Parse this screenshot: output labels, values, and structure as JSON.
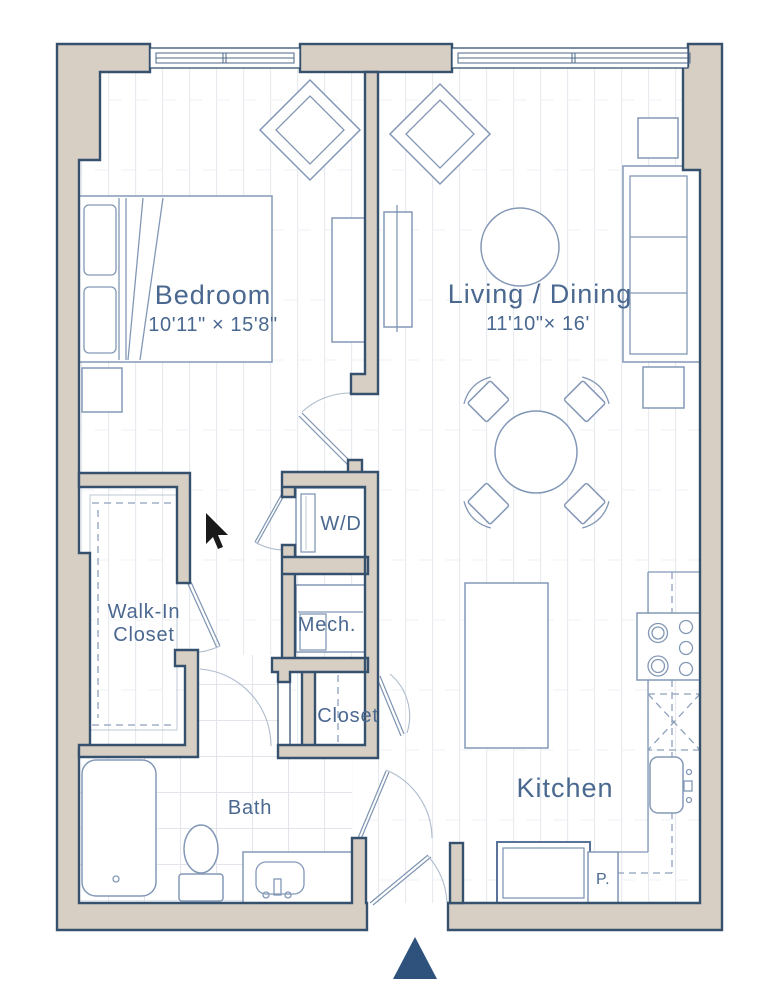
{
  "plan": {
    "colors": {
      "wall_fill": "#d7cfc3",
      "wall_outline": "#35516e",
      "furniture_line": "#8398b6",
      "label_text": "#4a6890",
      "floor_line": "#e7eaee",
      "tile_line": "#e2e6ec",
      "entry_marker": "#2e527c"
    },
    "rooms": {
      "bedroom": {
        "label": "Bedroom",
        "dims": "10'11\" × 15'8\""
      },
      "living_dining": {
        "label": "Living / Dining",
        "dims": "11'10\"× 16'"
      },
      "walk_in_closet": {
        "line1": "Walk-In",
        "line2": "Closet"
      },
      "laundry": {
        "label": "W/D"
      },
      "mechanical": {
        "label": "Mech."
      },
      "closet": {
        "label": "Closet"
      },
      "bath": {
        "label": "Bath"
      },
      "kitchen": {
        "label": "Kitchen"
      },
      "pantry": {
        "label": "P."
      }
    }
  }
}
